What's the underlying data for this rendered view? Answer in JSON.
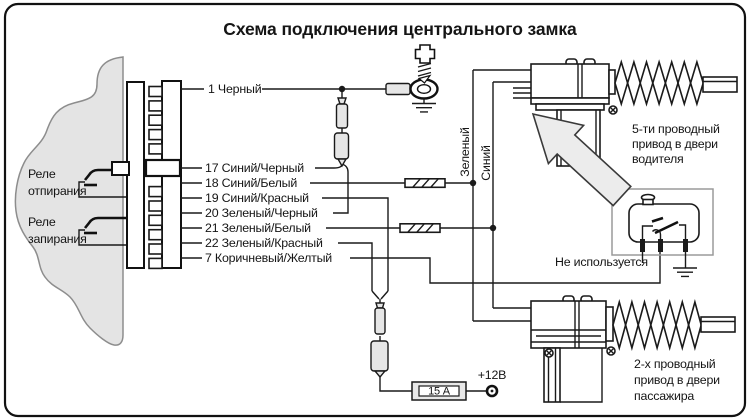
{
  "title": "Схема подключения центрального замка",
  "relay_unlock": {
    "line1": "Реле",
    "line2": "отпирания"
  },
  "relay_lock": {
    "line1": "Реле",
    "line2": "запирания"
  },
  "wires": [
    "1 Черный",
    "17 Синий/Черный",
    "18 Синий/Белый",
    "19 Синий/Красный",
    "20 Зеленый/Черный",
    "21 Зеленый/Белый",
    "22 Зеленый/Красный",
    "7 Коричневый/Желтый"
  ],
  "vertical_labels": {
    "green": "Зеленый",
    "blue": "Синий"
  },
  "driver_caption": [
    "5-ти проводный",
    "привод в двери",
    "водителя"
  ],
  "passenger_caption": [
    "2-х проводный",
    "привод в двери",
    "пассажира"
  ],
  "unused_label": "Не используется",
  "fuse_label": "15 А",
  "power_label": "+12В",
  "colors": {
    "line": "#1a1a1a",
    "gray_fill": "#e6e6e6",
    "box_border": "#9a9a9a",
    "background": "#ffffff"
  }
}
